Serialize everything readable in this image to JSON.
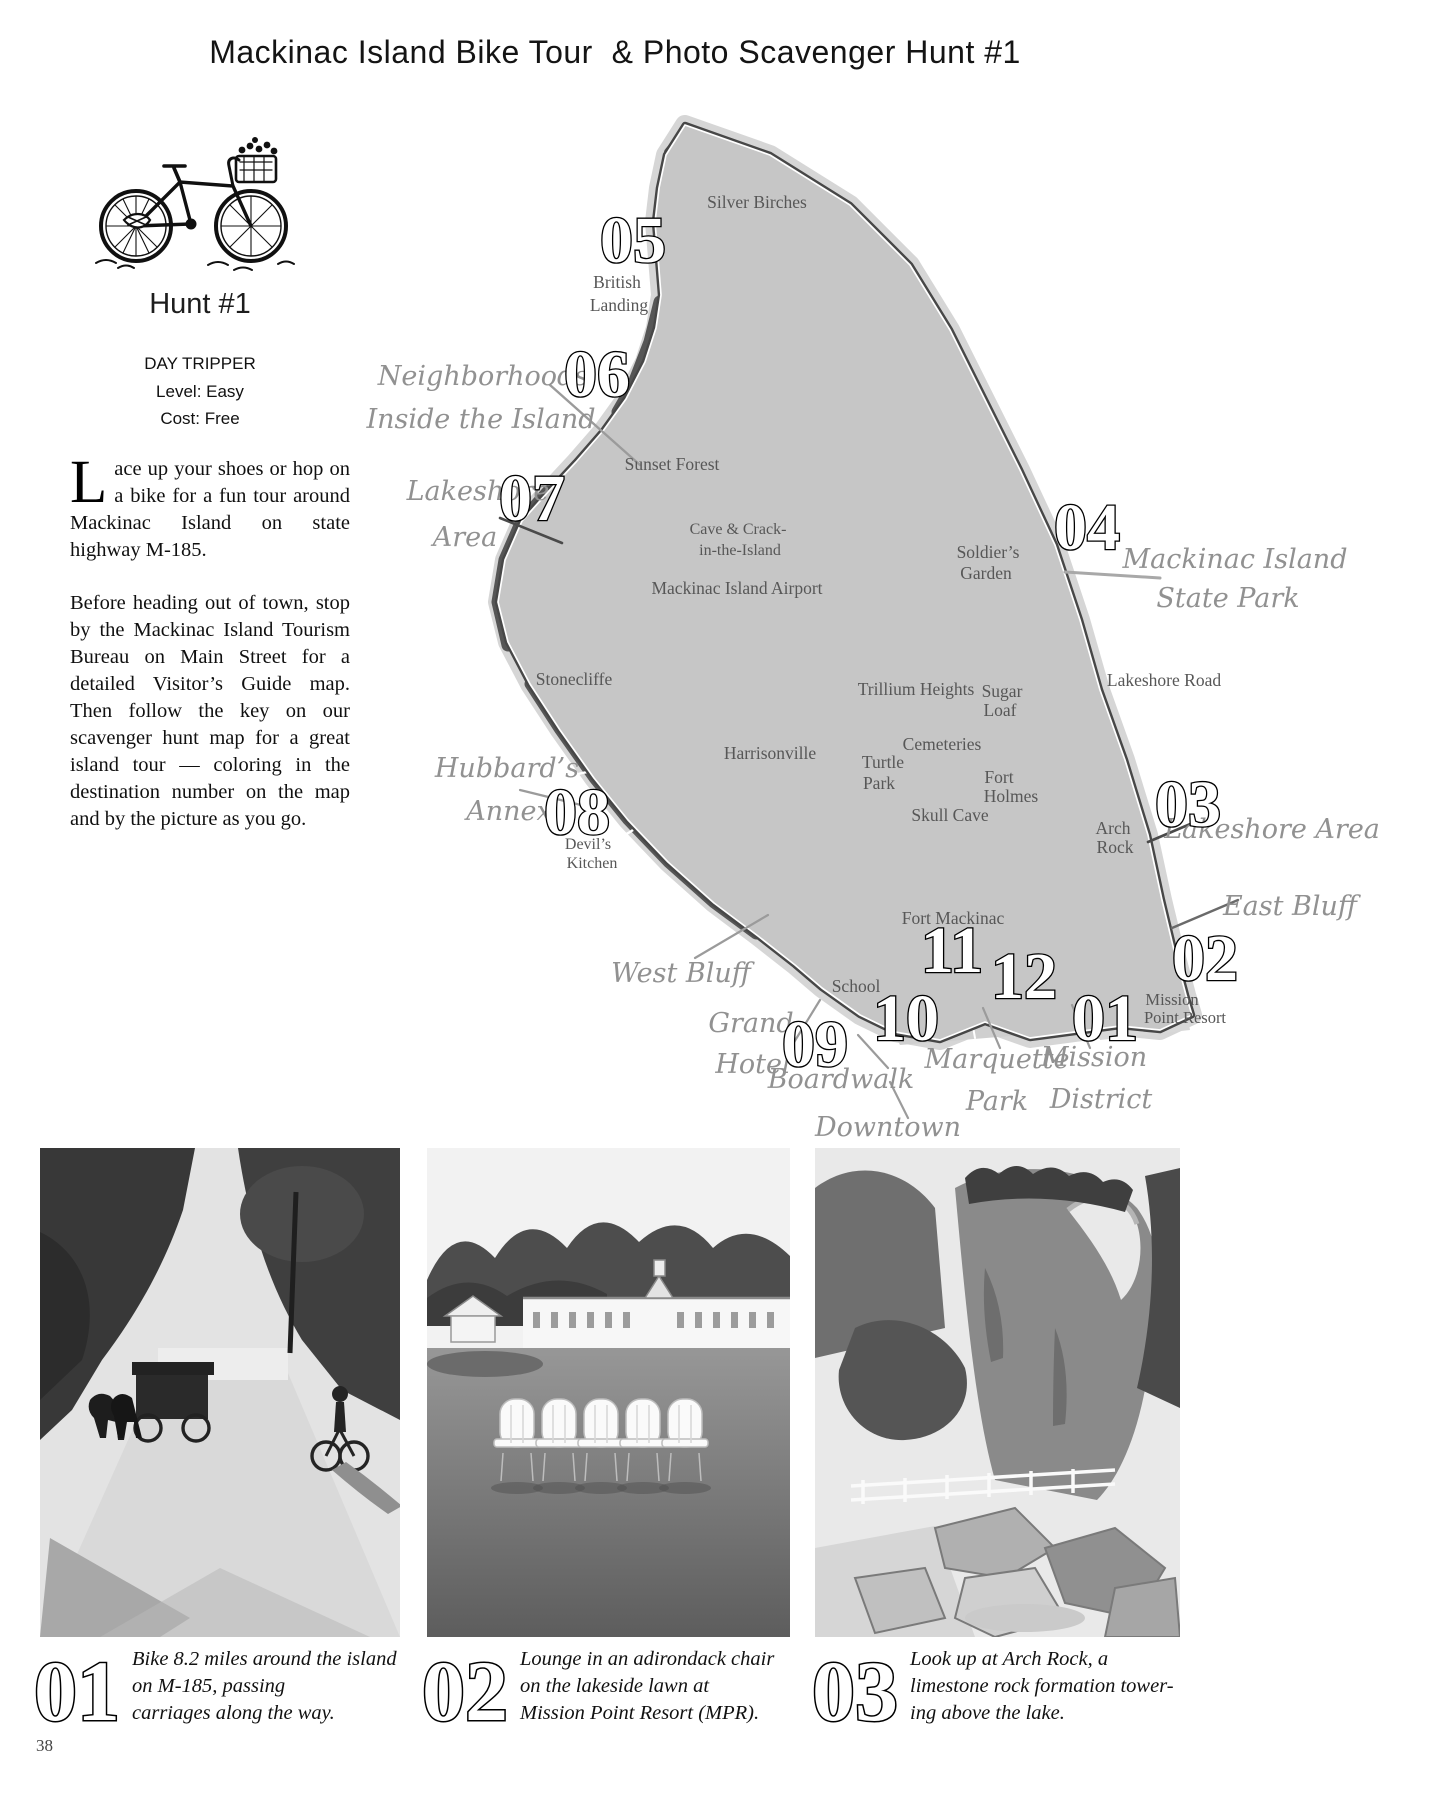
{
  "page": {
    "title": "Mackinac Island Bike Tour  & Photo Scavenger Hunt #1",
    "page_number": "38"
  },
  "colors": {
    "ink": "#1a1a1a",
    "map_land": "#c6c6c6",
    "map_road": "#474747",
    "map_label": "#575757",
    "map_script_label": "#919191"
  },
  "sidebar": {
    "hunt_title": "Hunt #1",
    "trip_type": "DAY TRIPPER",
    "level": "Level: Easy",
    "cost": "Cost: Free",
    "para1_dropcap": "L",
    "para1_rest": "ace up your shoes or hop on a bike for a fun tour around Mackinac Island on state highway M-185.",
    "para2": "Before heading out of town, stop by the Mackinac Island Tourism Bureau on Main Street for a detailed Visitor’s Guide map.  Then follow the key on our scavenger hunt map for a great island tour — coloring in the destination number on the map and by the picture as you go."
  },
  "map": {
    "labels": {
      "silver_birches": "Silver Birches",
      "british_1": "British",
      "british_2": "Landing",
      "sunset_forest": "Sunset Forest",
      "cave_1": "Cave & Crack-",
      "cave_2": "in-the-Island",
      "airport": "Mackinac Island Airport",
      "soldiers_1": "Soldier’s",
      "soldiers_2": "Garden",
      "lakeshore_road": "Lakeshore Road",
      "stonecliffe": "Stonecliffe",
      "trillium_heights": "Trillium Heights",
      "sugar_1": "Sugar",
      "sugar_2": "Loaf",
      "cemeteries": "Cemeteries",
      "harrisonville": "Harrisonville",
      "turtle_1": "Turtle",
      "turtle_2": "Park",
      "fort_holmes_1": "Fort",
      "fort_holmes_2": "Holmes",
      "skull_cave": "Skull Cave",
      "arch_1": "Arch",
      "arch_2": "Rock",
      "devils_1": "Devil’s",
      "devils_2": "Kitchen",
      "fort_mackinac": "Fort Mackinac",
      "school": "School",
      "mission_point_1": "Mission",
      "mission_point_2": "Point Resort"
    },
    "script": {
      "neighborhoods_1": "Neighborhoods",
      "neighborhoods_2": "Inside the Island",
      "lakeshore_w_1": "Lakeshore",
      "lakeshore_w_2": "Area",
      "state_park_1": "Mackinac Island",
      "state_park_2": "State Park",
      "hubbards_1": "Hubbard’s",
      "hubbards_2": "Annex",
      "lakeshore_e": "Lakeshore Area",
      "east_bluff": "East Bluff",
      "west_bluff": "West Bluff",
      "grand_1": "Grand",
      "grand_2": "Hotel",
      "boardwalk": "Boardwalk",
      "downtown": "Downtown",
      "marquette_1": "Marquette",
      "marquette_2": "Park",
      "mission_1": "Mission",
      "mission_2": "District"
    },
    "markers": {
      "m01": "01",
      "m02": "02",
      "m03": "03",
      "m04": "04",
      "m05": "05",
      "m06": "06",
      "m07": "07",
      "m08": "08",
      "m09": "09",
      "m10": "10",
      "m11": "11",
      "m12": "12"
    }
  },
  "photos": [
    {
      "number": "01",
      "lines": [
        "Bike 8.2 miles around the island",
        "on M-185, passing",
        "carriages along the way."
      ]
    },
    {
      "number": "02",
      "lines": [
        "Lounge in an adirondack chair",
        "on the lakeside lawn at",
        "Mission Point Resort (MPR)."
      ]
    },
    {
      "number": "03",
      "lines": [
        "Look up at Arch Rock, a",
        "limestone rock formation tower-",
        "ing above the lake."
      ]
    }
  ]
}
